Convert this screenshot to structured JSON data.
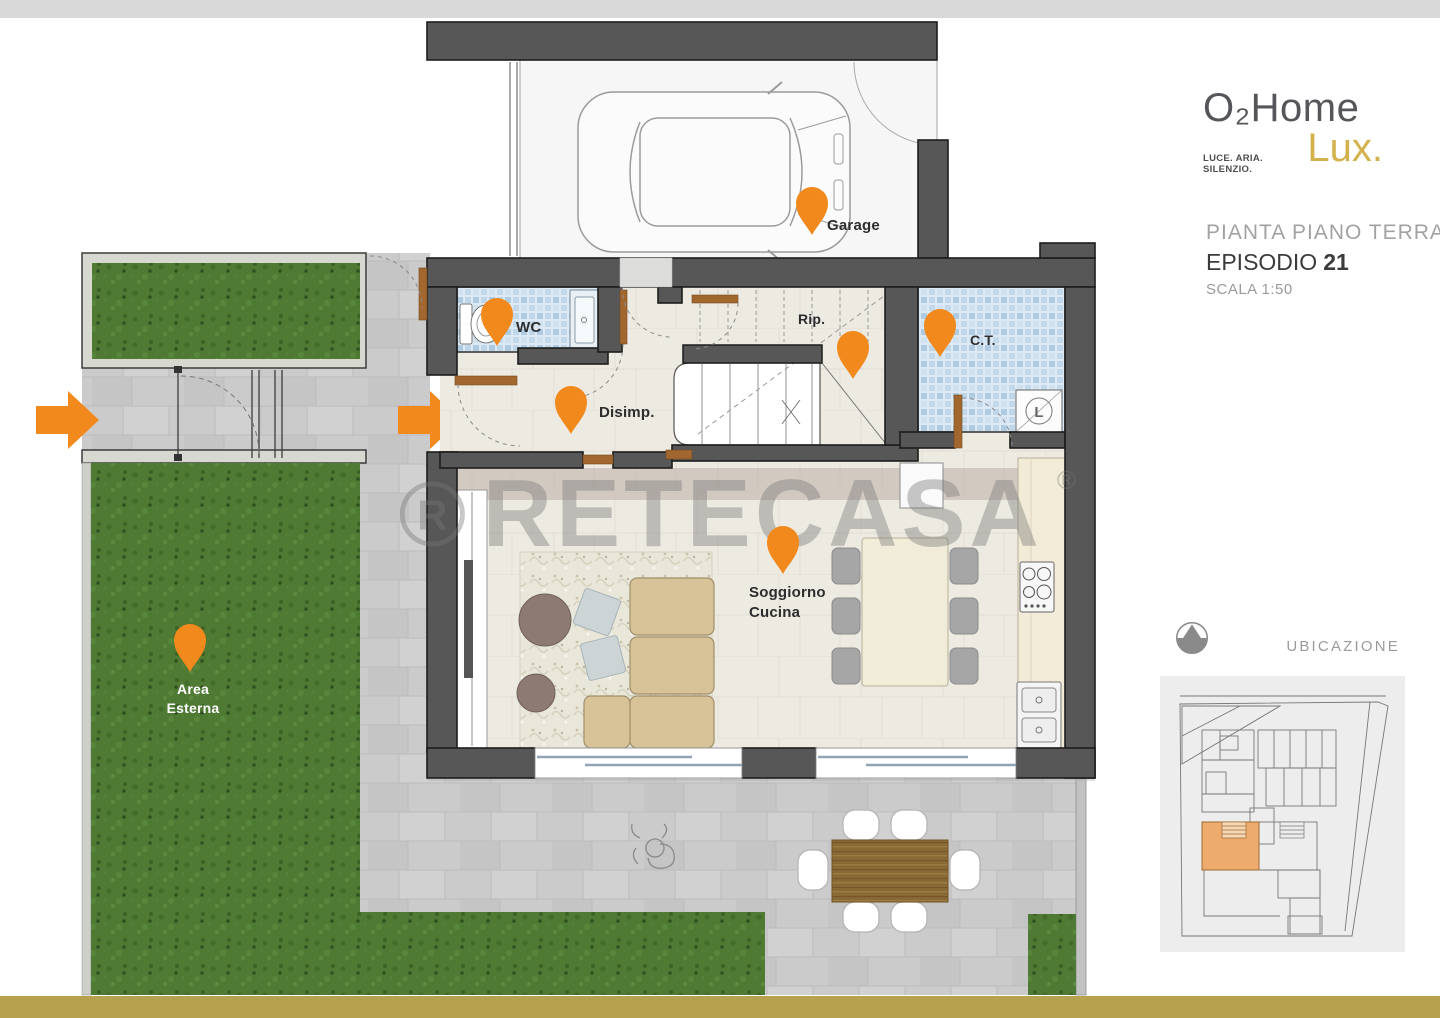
{
  "branding": {
    "logo_main": "O₂Home",
    "logo_tagline": "LUCE. ARIA. SILENZIO.",
    "logo_sub": "Lux."
  },
  "title_block": {
    "subtitle": "PIANTA PIANO TERRA",
    "episode_label": "EPISODIO",
    "episode_number": "21",
    "scale": "SCALA 1:50"
  },
  "ubicazione": {
    "label": "UBICAZIONE"
  },
  "watermark": {
    "text": "RETECASA",
    "reg": "®",
    "logo_letter": "R"
  },
  "rooms": {
    "garage": {
      "label": "Garage"
    },
    "wc": {
      "label": "WC"
    },
    "rip": {
      "label": "Rip."
    },
    "disimp": {
      "label": "Disimp."
    },
    "ct": {
      "label": "C.T."
    },
    "soggiorno": {
      "label_line1": "Soggiorno",
      "label_line2": "Cucina"
    },
    "area_esterna": {
      "label_line1": "Area",
      "label_line2": "Esterna"
    }
  },
  "laundry_symbol": "L",
  "colors": {
    "accent_orange": "#f1891d",
    "brand_gold": "#d3b24b",
    "footer_gold": "#b5a14e",
    "wall_gray": "#575757",
    "grass_green": "#4e7a33",
    "mosaic_blue": "#c4d9ea",
    "floor_beige": "#edeae2",
    "paving_gray": "#cbcbcb"
  }
}
